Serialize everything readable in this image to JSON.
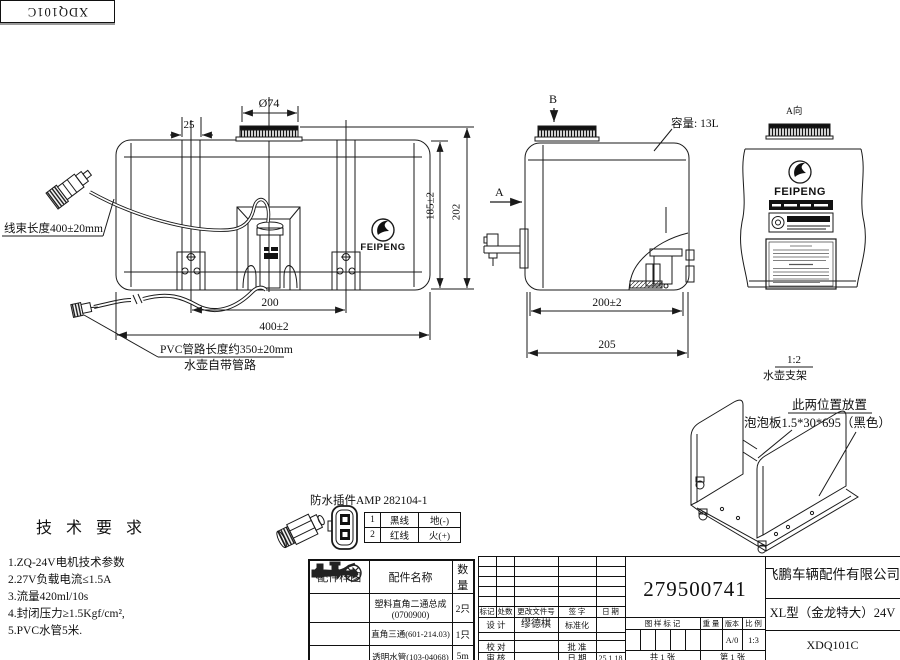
{
  "sheet": {
    "corner_code": "XDQ101C"
  },
  "front_view": {
    "dim_cap_diameter": "Ø74",
    "dim_strap_offset": "25",
    "dim_body_height": "185±2",
    "dim_total_height": "202",
    "dim_pump_spacing": "200",
    "dim_body_width": "400±2",
    "harness_label": "线束长度400±20mm",
    "pvc_label": "PVC管路长度约350±20mm",
    "pipe_label": "水壶自带管路",
    "brand": "FEIPENG"
  },
  "side_view": {
    "view_b": "B",
    "view_a": "A",
    "capacity_label": "容量: 13L",
    "dim_inner_width": "200±2",
    "dim_outer_width": "205"
  },
  "a_view": {
    "title": "A向",
    "brand": "FEIPENG"
  },
  "bracket": {
    "scale": "1:2",
    "name": "水壶支架",
    "note_line1": "此两位置放置",
    "note_line2": "泡泡板1.5*30*695（黑色）"
  },
  "tech_requirements": {
    "title": "技 术 要 求",
    "items": [
      "1.ZQ-24V电机技术参数",
      "2.27V负载电流≤1.5A",
      "3.流量420ml/10s",
      "4.封闭压力≥1.5Kgf/cm²,",
      "5.PVC水管5米."
    ]
  },
  "connector_table": {
    "title": "防水插件AMP 282104-1",
    "rows": [
      {
        "no": "1",
        "wire": "黑线",
        "function": "地(-)"
      },
      {
        "no": "2",
        "wire": "红线",
        "function": "火(+)"
      }
    ]
  },
  "parts_table": {
    "headers": [
      "配件样图",
      "配件名称",
      "数量"
    ],
    "rows": [
      {
        "name_line1": "塑料直角二通总成",
        "name_line2": "(0700900)",
        "qty": "2只"
      },
      {
        "name_line1": "直角三通(601-214.03)",
        "name_line2": "",
        "qty": "1只"
      },
      {
        "name_line1": "透明水管(103-04068)",
        "name_line2": "",
        "qty": "5m"
      }
    ]
  },
  "title_block": {
    "drawing_number": "279500741",
    "company": "飞鹏车辆配件有限公司",
    "model": "XL型（金龙特大）24V",
    "code": "XDQ101C",
    "col_mark": "标记",
    "col_count": "处数",
    "col_file": "更改文件号",
    "col_sign": "签 字",
    "col_date": "日 期",
    "design_label": "设 计",
    "designer": "缪德棋",
    "standard_label": "标准化",
    "check_label": "校 对",
    "approve_label": "批 准",
    "audit_label": "审 核",
    "date_label": "日 期",
    "date_value": "25.1.18",
    "stamp_label": "图 样 标 记",
    "weight_label": "重 量",
    "version_label": "版本",
    "scale_label": "比 例",
    "version_value": "A/0",
    "scale_value": "1:3",
    "sheet_total": "共 1 张",
    "sheet_index": "第 1 张"
  }
}
